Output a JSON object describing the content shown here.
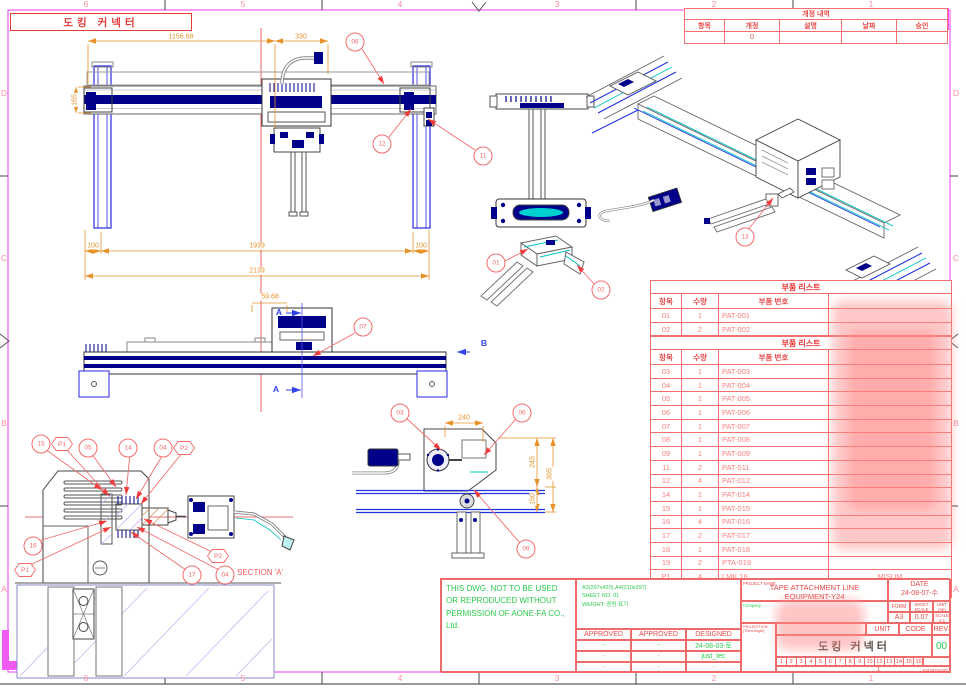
{
  "frame": {
    "top_labels": [
      "6",
      "5",
      "4",
      "3",
      "2",
      "1"
    ],
    "bottom_labels": [
      "6",
      "5",
      "4",
      "3",
      "2",
      "1"
    ],
    "left_labels": [
      "D",
      "C",
      "B",
      "A"
    ],
    "right_labels": [
      "D",
      "C",
      "B",
      "A"
    ]
  },
  "title_box": "도킹 커넥터",
  "revision_table": {
    "title": "개정 내역",
    "headers": [
      "항목",
      "개정",
      "설명",
      "날짜",
      "승인"
    ],
    "row": [
      "",
      "0",
      "",
      "",
      ""
    ]
  },
  "parts_lists": [
    {
      "title": "부품 리스트",
      "headers": [
        "항목",
        "수량",
        "부품 번호",
        ""
      ],
      "rows": [
        [
          "01",
          "1",
          "PAT-001",
          ""
        ],
        [
          "02",
          "2",
          "PAT-002",
          ""
        ]
      ]
    },
    {
      "title": "부품 리스트",
      "headers": [
        "항목",
        "수량",
        "부품 번호",
        ""
      ],
      "rows": [
        [
          "03",
          "1",
          "PAT-003",
          ""
        ],
        [
          "04",
          "1",
          "PAT-004",
          ""
        ],
        [
          "05",
          "1",
          "PAT-005",
          ""
        ],
        [
          "06",
          "1",
          "PAT-006",
          ""
        ],
        [
          "07",
          "1",
          "PAT-007",
          ""
        ],
        [
          "08",
          "1",
          "PAT-008",
          ""
        ],
        [
          "09",
          "1",
          "PAT-009",
          ""
        ],
        [
          "11",
          "2",
          "PAT-011",
          ""
        ],
        [
          "12",
          "4",
          "PAT-012",
          ""
        ],
        [
          "14",
          "1",
          "PAT-014",
          ""
        ],
        [
          "15",
          "1",
          "PAT-015",
          ""
        ],
        [
          "16",
          "4",
          "PAT-016",
          ""
        ],
        [
          "17",
          "2",
          "PAT-017",
          ""
        ],
        [
          "18",
          "1",
          "PAT-018",
          ""
        ],
        [
          "19",
          "2",
          "PTA-019",
          ""
        ],
        [
          "P1",
          "4",
          "LMK 16",
          "MISUM"
        ],
        [
          "P2",
          "4",
          "WR22-20",
          "MISUM"
        ]
      ]
    }
  ],
  "dimensions": {
    "top_width": "1156.68",
    "top_offset": "330",
    "beam_height": "165",
    "left_col": "100",
    "span": "1939",
    "right_col": "100",
    "total": "2139",
    "carriage_offset": "59.68",
    "detail_width": "240",
    "detail_upper": "245",
    "detail_lower": "150",
    "detail_total": "395"
  },
  "balloons": {
    "01": "01",
    "02": "02",
    "03": "03",
    "04": "04",
    "05": "05",
    "06": "06",
    "07": "07",
    "08": "08",
    "09": "09",
    "11": "11",
    "12": "12",
    "13": "13",
    "14": "14",
    "15": "15",
    "16": "16",
    "17": "17",
    "P1": "P1",
    "P2": "P2"
  },
  "section_view": {
    "label": "SECTION 'A'",
    "arrow_a": "A",
    "arrow_b": "B"
  },
  "copyright": {
    "line1": "THIS DWG. NOT TO  BE USED",
    "line2": "OR REPRODUCED WITHOUT",
    "line3": "PERMISSION OF AONE-FA CO.,",
    "line4": "Ltd."
  },
  "title_block": {
    "paper_info": "A3(297x420),A4(210x297)",
    "sheet_no": "SHEET NO. 01",
    "weight": "WEIGHT: 중량 표기",
    "approve_headers": [
      "APPROVED",
      "APPROVED",
      "DESIGNED"
    ],
    "approve_rows": [
      [
        "-",
        "-",
        "24-08-03-토"
      ],
      [
        "-",
        "-",
        "just_tec"
      ],
      [
        "-",
        "-",
        "-"
      ]
    ],
    "project_label": "PROJECT NAME",
    "project_line1": "TAPE ATTACHMENT LINE",
    "project_line2": "EQUIPMENT-Y24",
    "date_label": "DATE",
    "date_value": "24-08-07-수",
    "company_label": "Company",
    "form_label": "FORM",
    "form_value": "A3",
    "sheet_scale_label": "SHEET SCALE",
    "sheet_scale_value": "0.07",
    "unit_label": "UNIT",
    "unit_value": "mm",
    "scale_label": "SCALE",
    "scale_value": "1:1",
    "unit2_label": "UNIT",
    "code_label": "CODE",
    "rev_label": "REV.",
    "projection_label": "PROJECTION [Third Angle]",
    "drawing_title": "도킹 커넥터",
    "rev_value": "00",
    "cell_numbers": [
      "1",
      "2",
      "3",
      "4",
      "5",
      "6",
      "7",
      "8",
      "9",
      "10",
      "12",
      "13",
      "14",
      "15",
      "16"
    ],
    "sheet_count": "1",
    "paper_size": "A3(297x420)"
  }
}
